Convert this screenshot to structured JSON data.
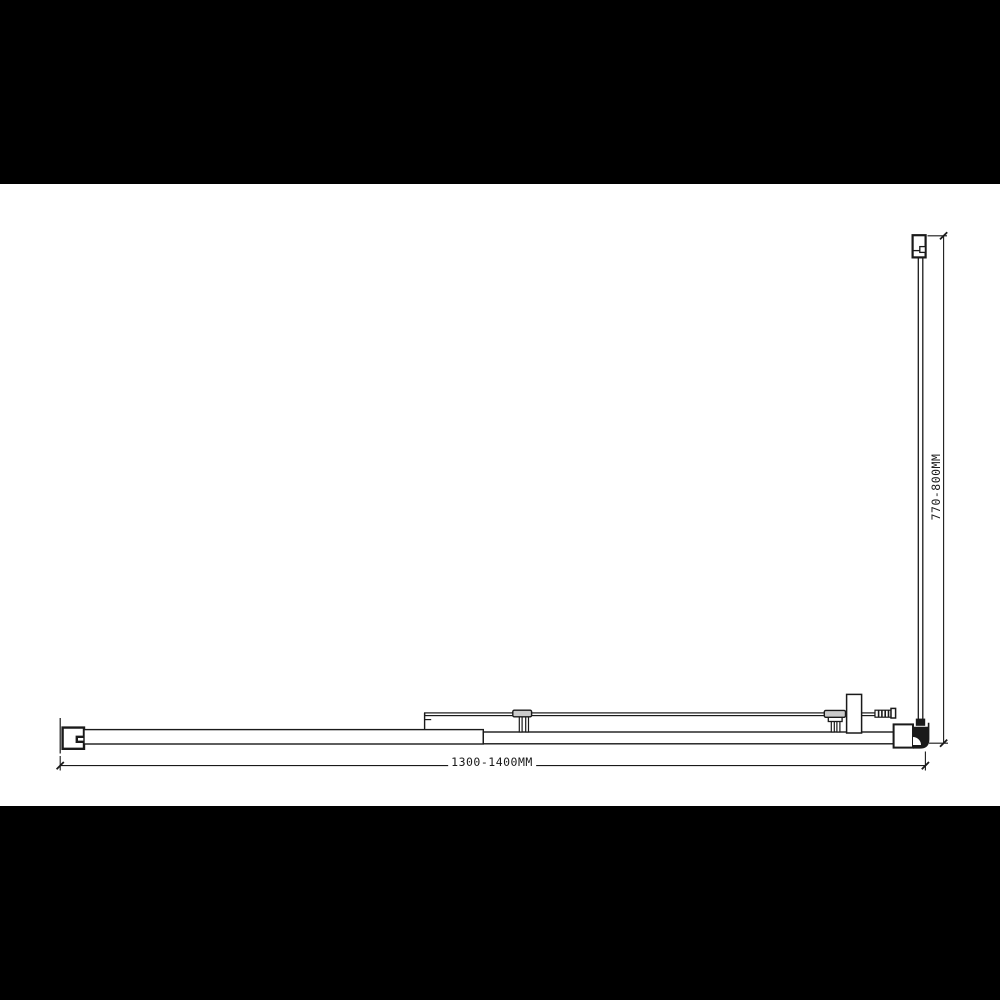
{
  "page": {
    "background_color": "#ffffff",
    "letterbox_color": "#000000"
  },
  "drawing": {
    "kind": "technical-plan-drawing",
    "subject": "shower enclosure plan view",
    "ink_color": "#1a1a1a",
    "roller_fill_color": "#cbcbcb",
    "dimensions": {
      "width": {
        "label": "1300-1400MM"
      },
      "depth": {
        "label": "770-800MM"
      }
    }
  }
}
